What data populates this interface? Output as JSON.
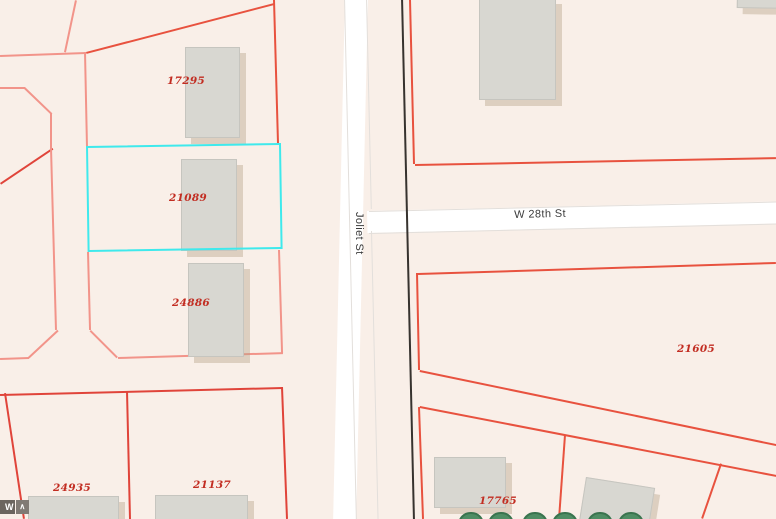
{
  "map": {
    "parcels": [
      {
        "id": "17295",
        "selected": false
      },
      {
        "id": "21089",
        "selected": true
      },
      {
        "id": "24886",
        "selected": false
      },
      {
        "id": "21605",
        "selected": false
      },
      {
        "id": "24935",
        "selected": false
      },
      {
        "id": "21137",
        "selected": false
      },
      {
        "id": "17765",
        "selected": false
      }
    ],
    "streets": [
      {
        "name": "Joliet St",
        "orientation": "vertical"
      },
      {
        "name": "W 28th St",
        "orientation": "horizontal"
      }
    ],
    "selection": {
      "parcel_id": "21089",
      "outline_color": "#3FE9EC"
    },
    "symbols": {
      "tree_count": 6
    },
    "colors": {
      "background": "#F9EFE8",
      "parcel_line": "#E8523F",
      "parcel_line_strong": "#E0443A",
      "parcel_line_light": "#F2948A",
      "street_fill": "#FFFFFF",
      "street_border": "#E3DFDB",
      "building_fill": "#D8D7D1",
      "building_border": "#C6C5BF",
      "parcel_label_text": "#C22D22",
      "street_label_text": "#3B3B3B",
      "utility_line": "#37332F",
      "tree_fill": "#4F8D64",
      "tree_border": "#3A744F"
    },
    "toolbar": {
      "label": "W",
      "chevron": "∧"
    }
  }
}
